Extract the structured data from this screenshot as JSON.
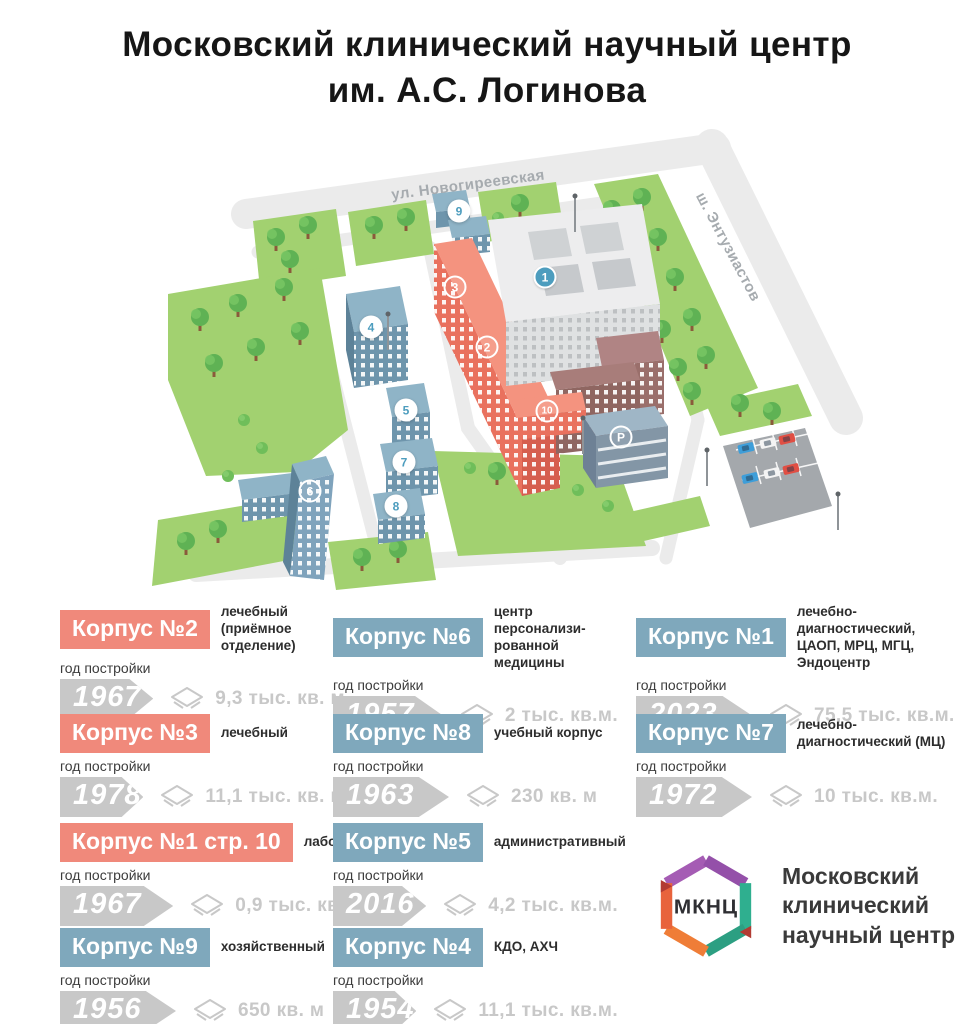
{
  "title": {
    "line1": "Московский клинический научный центр",
    "line2": "им. А.С. Логинова"
  },
  "map": {
    "streets": [
      {
        "name": "ул. Новогиреевская"
      },
      {
        "name": "ш. Энтузиастов"
      }
    ],
    "badges": [
      {
        "label": "1"
      },
      {
        "label": "2"
      },
      {
        "label": "3"
      },
      {
        "label": "4"
      },
      {
        "label": "5"
      },
      {
        "label": "6"
      },
      {
        "label": "7"
      },
      {
        "label": "8"
      },
      {
        "label": "9"
      },
      {
        "label": "10"
      },
      {
        "label": "P"
      }
    ]
  },
  "legend": {
    "year_label": "год постройки",
    "cards": [
      {
        "name": "Корпус №2",
        "desc": "лечебный\n(приёмное отделение)",
        "year": "1967",
        "area": "9,3 тыс. кв. м",
        "color": "#F0897B"
      },
      {
        "name": "Корпус №6",
        "desc": "центр персонализи-\nрованной медицины",
        "year": "1957",
        "area": "2 тыс. кв.м.",
        "color": "#7FA8BC"
      },
      {
        "name": "Корпус №1",
        "desc": "лечебно-диагностический,\nЦАОП, МРЦ, МГЦ, Эндоцентр",
        "year": "2023",
        "area": "75,5 тыс. кв.м.",
        "color": "#7FA8BC"
      },
      {
        "name": "Корпус №3",
        "desc": "лечебный",
        "year": "1978",
        "area": "11,1 тыс. кв. м",
        "color": "#F0897B"
      },
      {
        "name": "Корпус №8",
        "desc": "учебный корпус",
        "year": "1963",
        "area": "230 кв. м",
        "color": "#7FA8BC"
      },
      {
        "name": "Корпус №7",
        "desc": "лечебно-\nдиагностический (МЦ)",
        "year": "1972",
        "area": "10 тыс. кв.м.",
        "color": "#7FA8BC"
      },
      {
        "name": "Корпус №1 стр. 10",
        "desc": "лабораторный",
        "year": "1967",
        "area": "0,9 тыс. кв. м",
        "color": "#F0897B"
      },
      {
        "name": "Корпус №5",
        "desc": "административный",
        "year": "2016",
        "area": "4,2 тыс. кв.м.",
        "color": "#7FA8BC"
      },
      {
        "name": "Корпус №9",
        "desc": "хозяйственный",
        "year": "1956",
        "area": "650 кв. м",
        "color": "#7FA8BC"
      },
      {
        "name": "Корпус №4",
        "desc": "КДО, АХЧ",
        "year": "1954",
        "area": "11,1 тыс. кв.м.",
        "color": "#7FA8BC"
      }
    ]
  },
  "logo": {
    "abbr": "МКНЦ",
    "name": "Московский\nклинический\nнаучный центр"
  },
  "colors": {
    "salmon": "#F0897B",
    "blue": "#7FA8BC",
    "year_gray": "#C8C8C8",
    "grass": "#A2D170",
    "badge_blue": "#4D9DBE",
    "road": "#EBEBEB"
  }
}
